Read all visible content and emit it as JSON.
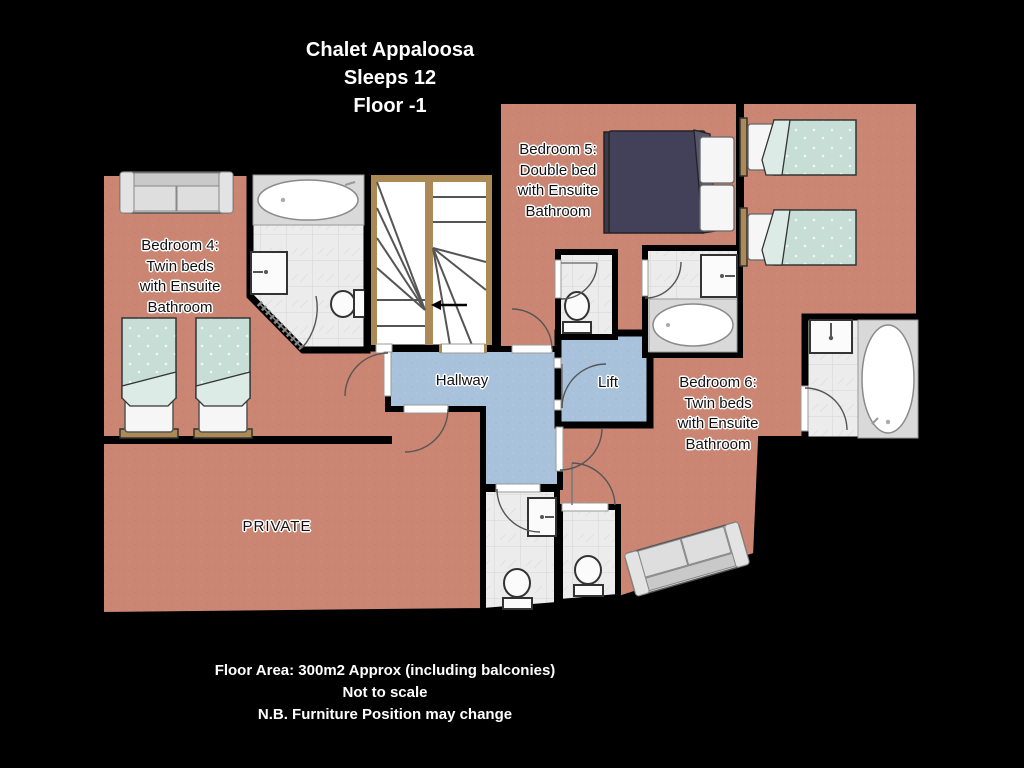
{
  "title": {
    "lines": [
      "Chalet Appaloosa",
      "Sleeps 12",
      "Floor -1"
    ]
  },
  "labels": {
    "bedroom4": {
      "lines": [
        "Bedroom 4:",
        "Twin beds",
        "with Ensuite",
        "Bathroom"
      ]
    },
    "bedroom5": {
      "lines": [
        "Bedroom 5:",
        "Double bed",
        "with Ensuite",
        "Bathroom"
      ]
    },
    "bedroom6": {
      "lines": [
        "Bedroom 6:",
        "Twin beds",
        "with Ensuite",
        "Bathroom"
      ]
    },
    "hallway": "Hallway",
    "lift": "Lift",
    "private": "PRIVATE"
  },
  "footer": {
    "lines": [
      "Floor Area: 300m2 Approx (including balconies)",
      "Not to scale",
      "N.B. Furniture Position may change"
    ]
  },
  "colors": {
    "background": "#000000",
    "room_fill": "#ca8673",
    "corridor_fill": "#a9c2dc",
    "tile_fill": "#ececec",
    "tile_line": "#dedcda",
    "bed_teal": "#c7ded7",
    "bed_teal_fold": "#dcebe6",
    "bed_dark": "#434159",
    "bed_dark_fold": "#55536e",
    "wood_tan": "#ab8a55",
    "sofa_gray": "#d6d6d6",
    "wall": "#000000",
    "text_dark": "#111111",
    "text_light": "#ffffff"
  }
}
